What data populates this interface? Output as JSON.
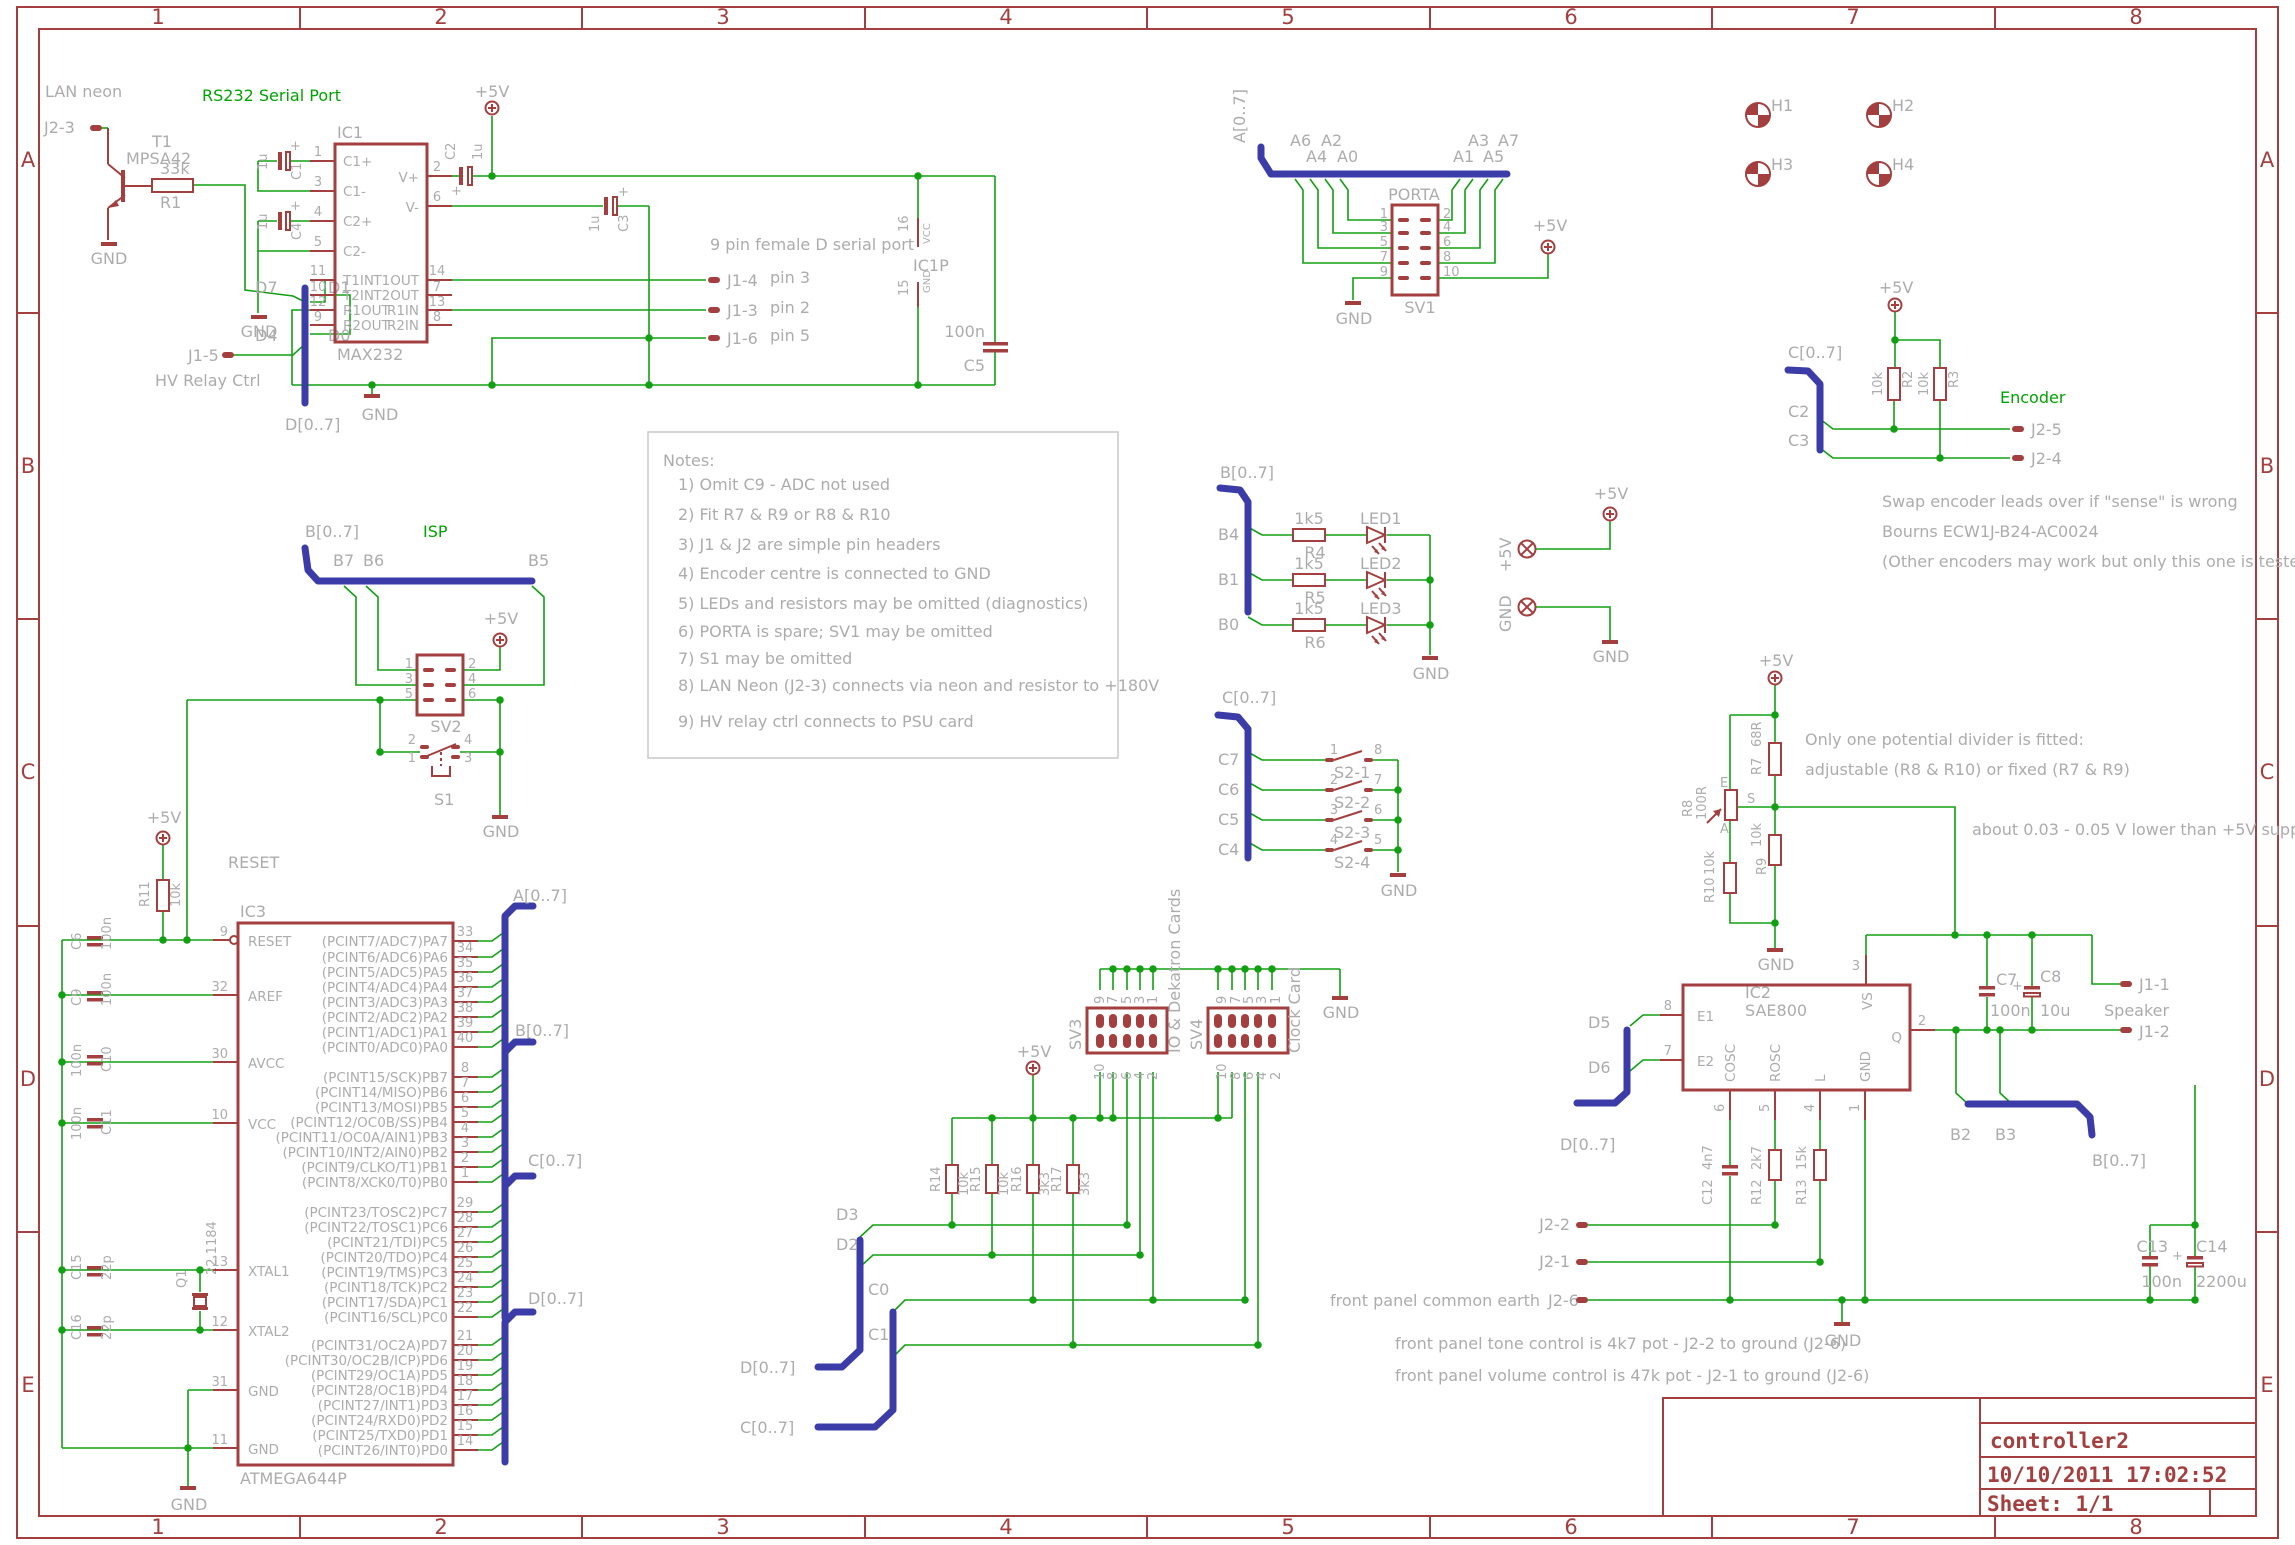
{
  "frame": {
    "cols": [
      "1",
      "2",
      "3",
      "4",
      "5",
      "6",
      "7",
      "8"
    ],
    "rows": [
      "A",
      "B",
      "C",
      "D",
      "E"
    ]
  },
  "title": {
    "project": "controller2",
    "date": "10/10/2011 17:02:52",
    "sheet": "Sheet: 1/1"
  },
  "headers": {
    "rs232": "RS232 Serial Port",
    "isp": "ISP",
    "encoder": "Encoder",
    "porta": "PORTA"
  },
  "notes": {
    "title": "Notes:",
    "items": [
      "1) Omit C9 - ADC not used",
      "2) Fit R7 & R9 or R8 & R10",
      "3) J1 & J2 are simple pin headers",
      "4) Encoder centre is connected to GND",
      "5) LEDs and resistors may be omitted (diagnostics)",
      "6) PORTA is spare; SV1 may be omitted",
      "7) S1 may be omitted",
      "8) LAN Neon (J2-3) connects via neon and resistor to +180V",
      "9) HV relay ctrl connects to PSU card"
    ]
  },
  "annot": {
    "lan": "LAN neon",
    "hv": "HV Relay Ctrl",
    "serial": "9 pin female D serial port",
    "pin3": "pin 3",
    "pin2": "pin 2",
    "pin5": "pin 5",
    "enc1": "Swap encoder leads over if \"sense\" is wrong",
    "enc2": "Bourns ECW1J-B24-AC0024",
    "enc3": "(Other encoders may work but only this one is tested.)",
    "div1": "Only one potential divider is fitted:",
    "div2": "adjustable (R8 & R10) or fixed (R7 & R9)",
    "div3": "about 0.03 - 0.05 V lower than +5V supply",
    "fp_earth": "front panel common earth",
    "fp_tone": "front panel tone control is 4k7 pot - J2-2 to ground (J2-6)",
    "fp_vol": "front panel volume control is 47k pot - J2-1 to ground (J2-6)",
    "io_cards": "IO & Dekatron Cards",
    "clock_card": "Clock Card",
    "speaker": "Speaker"
  },
  "power": {
    "p5": "+5V",
    "gnd": "GND"
  },
  "bus": {
    "a": "A[0..7]",
    "b": "B[0..7]",
    "c": "C[0..7]",
    "d": "D[0..7]"
  },
  "net": {
    "d7": "D7",
    "d1": "D1",
    "d4": "D4",
    "d0": "D0",
    "d3": "D3",
    "d2": "D2",
    "d5": "D5",
    "d6": "D6",
    "b7": "B7",
    "b6": "B6",
    "b5": "B5",
    "b4": "B4",
    "b1": "B1",
    "b0": "B0",
    "b2": "B2",
    "b3": "B3",
    "c7": "C7",
    "c6": "C6",
    "c5": "C5",
    "c4": "C4",
    "c2": "C2",
    "c3": "C3",
    "c0": "C0",
    "c1": "C1",
    "reset": "RESET",
    "a6": "A6",
    "a4": "A4",
    "a2": "A2",
    "a0": "A0",
    "a3": "A3",
    "a1": "A1",
    "a7": "A7",
    "a5": "A5"
  },
  "parts": {
    "t1": {
      "name": "T1",
      "value": "MPSA42"
    },
    "r1": {
      "name": "R1",
      "value": "33k"
    },
    "r2": {
      "name": "R2",
      "value": "10k"
    },
    "r3": {
      "name": "R3",
      "value": "10k"
    },
    "r4": {
      "name": "R4",
      "value": "1k5"
    },
    "r5": {
      "name": "R5",
      "value": "1k5"
    },
    "r6": {
      "name": "R6",
      "value": "1k5"
    },
    "r7": {
      "name": "R7",
      "value": "68R"
    },
    "r8": {
      "name": "R8",
      "value": "100R"
    },
    "r9": {
      "name": "R9",
      "value": "10k"
    },
    "r10": {
      "name": "R10",
      "value": "10k"
    },
    "r11": {
      "name": "R11",
      "value": "10k"
    },
    "r12": {
      "name": "R12",
      "value": "2k7"
    },
    "r13": {
      "name": "R13",
      "value": "15k"
    },
    "r14": {
      "name": "R14",
      "value": "10k"
    },
    "r15": {
      "name": "R15",
      "value": "10k"
    },
    "r16": {
      "name": "R16",
      "value": "3k3"
    },
    "r17": {
      "name": "R17",
      "value": "3k3"
    },
    "c1": {
      "name": "C1",
      "value": "1u"
    },
    "c2": {
      "name": "C2",
      "value": "1u"
    },
    "c3": {
      "name": "C3",
      "value": "1u"
    },
    "c4": {
      "name": "C4",
      "value": "1u"
    },
    "c5": {
      "name": "C5",
      "value": "100n"
    },
    "c6": {
      "name": "C6",
      "value": "100n"
    },
    "c7": {
      "name": "C7",
      "value": "100n"
    },
    "c8": {
      "name": "C8",
      "value": "10u"
    },
    "c9": {
      "name": "C9",
      "value": "100n"
    },
    "c10": {
      "name": "C10",
      "value": "100n"
    },
    "c11": {
      "name": "C11",
      "value": "100n"
    },
    "c12": {
      "name": "C12",
      "value": "4n7"
    },
    "c13": {
      "name": "C13",
      "value": "100n"
    },
    "c14": {
      "name": "C14",
      "value": "2200u"
    },
    "c15": {
      "name": "C15",
      "value": "22p"
    },
    "c16": {
      "name": "C16",
      "value": "22p"
    },
    "q1": {
      "name": "Q1",
      "value": "22.1184"
    },
    "ic1": {
      "name": "IC1",
      "value": "MAX232"
    },
    "ic1p": {
      "name": "IC1P"
    },
    "ic2": {
      "name": "IC2",
      "value": "SAE800"
    },
    "ic3": {
      "name": "IC3",
      "value": "ATMEGA644P"
    },
    "sv1": "SV1",
    "sv2": "SV2",
    "sv3": "SV3",
    "sv4": "SV4",
    "s1": "S1",
    "led1": "LED1",
    "led2": "LED2",
    "led3": "LED3",
    "h1": "H1",
    "h2": "H2",
    "h3": "H3",
    "h4": "H4",
    "plus": "+"
  },
  "s2": [
    {
      "name": "S2-1",
      "l": "1",
      "r": "8"
    },
    {
      "name": "S2-2",
      "l": "2",
      "r": "7"
    },
    {
      "name": "S2-3",
      "l": "3",
      "r": "6"
    },
    {
      "name": "S2-4",
      "l": "4",
      "r": "5"
    }
  ],
  "j": {
    "j23": "J2-3",
    "j15": "J1-5",
    "j14": "J1-4",
    "j13": "J1-3",
    "j16": "J1-6",
    "j25": "J2-5",
    "j24": "J2-4",
    "j11": "J1-1",
    "j12": "J1-2",
    "j22": "J2-2",
    "j21": "J2-1",
    "j26": "J2-6"
  },
  "ic1_pins": {
    "left": [
      {
        "n": "1",
        "t": "C1+"
      },
      {
        "n": "3",
        "t": "C1-"
      },
      {
        "n": "4",
        "t": "C2+"
      },
      {
        "n": "5",
        "t": "C2-"
      },
      {
        "n": "11",
        "t": "T1IN"
      },
      {
        "n": "10",
        "t": "T2IN"
      },
      {
        "n": "12",
        "t": "R1OUT"
      },
      {
        "n": "9",
        "t": "R2OUT"
      }
    ],
    "right": [
      {
        "n": "2",
        "t": "V+"
      },
      {
        "n": "6",
        "t": "V-"
      },
      {
        "n": "14",
        "t": "T1OUT"
      },
      {
        "n": "7",
        "t": "T2OUT"
      },
      {
        "n": "13",
        "t": "R1IN"
      },
      {
        "n": "8",
        "t": "R2IN"
      }
    ]
  },
  "ic1p_pins": {
    "p16": "16",
    "vcc": "VCC",
    "p15": "15",
    "gnd": "GND"
  },
  "ic2_pins": {
    "e1": {
      "n": "8",
      "t": "E1"
    },
    "e2": {
      "n": "7",
      "t": "E2"
    },
    "cosc": {
      "n": "6",
      "t": "COSC"
    },
    "rosc": {
      "n": "5",
      "t": "ROSC"
    },
    "l": {
      "n": "4",
      "t": "L"
    },
    "gnd": {
      "n": "1",
      "t": "GND"
    },
    "vs": {
      "n": "3",
      "t": "VS"
    },
    "q": {
      "n": "2",
      "t": "Q"
    }
  },
  "ic3_pins": {
    "left": [
      {
        "n": "9",
        "t": "RESET"
      },
      {
        "n": "32",
        "t": "AREF"
      },
      {
        "n": "30",
        "t": "AVCC"
      },
      {
        "n": "10",
        "t": "VCC"
      },
      {
        "n": "13",
        "t": "XTAL1"
      },
      {
        "n": "12",
        "t": "XTAL2"
      },
      {
        "n": "31",
        "t": "GND"
      },
      {
        "n": "11",
        "t": "GND"
      }
    ],
    "pa": [
      {
        "n": "33",
        "t": "(PCINT7/ADC7)PA7"
      },
      {
        "n": "34",
        "t": "(PCINT6/ADC6)PA6"
      },
      {
        "n": "35",
        "t": "(PCINT5/ADC5)PA5"
      },
      {
        "n": "36",
        "t": "(PCINT4/ADC4)PA4"
      },
      {
        "n": "37",
        "t": "(PCINT3/ADC3)PA3"
      },
      {
        "n": "38",
        "t": "(PCINT2/ADC2)PA2"
      },
      {
        "n": "39",
        "t": "(PCINT1/ADC1)PA1"
      },
      {
        "n": "40",
        "t": "(PCINT0/ADC0)PA0"
      }
    ],
    "pb": [
      {
        "n": "8",
        "t": "(PCINT15/SCK)PB7"
      },
      {
        "n": "7",
        "t": "(PCINT14/MISO)PB6"
      },
      {
        "n": "6",
        "t": "(PCINT13/MOSI)PB5"
      },
      {
        "n": "5",
        "t": "(PCINT12/OC0B/SS)PB4"
      },
      {
        "n": "4",
        "t": "(PCINT11/OC0A/AIN1)PB3"
      },
      {
        "n": "3",
        "t": "(PCINT10/INT2/AIN0)PB2"
      },
      {
        "n": "2",
        "t": "(PCINT9/CLKO/T1)PB1"
      },
      {
        "n": "1",
        "t": "(PCINT8/XCK0/T0)PB0"
      }
    ],
    "pc": [
      {
        "n": "29",
        "t": "(PCINT23/TOSC2)PC7"
      },
      {
        "n": "28",
        "t": "(PCINT22/TOSC1)PC6"
      },
      {
        "n": "27",
        "t": "(PCINT21/TDI)PC5"
      },
      {
        "n": "26",
        "t": "(PCINT20/TDO)PC4"
      },
      {
        "n": "25",
        "t": "(PCINT19/TMS)PC3"
      },
      {
        "n": "24",
        "t": "(PCINT18/TCK)PC2"
      },
      {
        "n": "23",
        "t": "(PCINT17/SDA)PC1"
      },
      {
        "n": "22",
        "t": "(PCINT16/SCL)PC0"
      }
    ],
    "pd": [
      {
        "n": "21",
        "t": "(PCINT31/OC2A)PD7"
      },
      {
        "n": "20",
        "t": "(PCINT30/OC2B/ICP)PD6"
      },
      {
        "n": "19",
        "t": "(PCINT29/OC1A)PD5"
      },
      {
        "n": "18",
        "t": "(PCINT28/OC1B)PD4"
      },
      {
        "n": "17",
        "t": "(PCINT27/INT1)PD3"
      },
      {
        "n": "16",
        "t": "(PCINT24/RXD0)PD2"
      },
      {
        "n": "15",
        "t": "(PCINT25/TXD0)PD1"
      },
      {
        "n": "14",
        "t": "(PCINT26/INT0)PD0"
      }
    ]
  },
  "sv1_pins": {
    "l": [
      "1",
      "3",
      "5",
      "7",
      "9"
    ],
    "r": [
      "2",
      "4",
      "6",
      "8",
      "10"
    ]
  },
  "sv2_pins": {
    "l": [
      "1",
      "3",
      "5"
    ],
    "r": [
      "2",
      "4",
      "6"
    ]
  },
  "s1_pins": {
    "p2": "2",
    "p1": "1",
    "p4": "4",
    "p3": "3"
  },
  "sv34_pins": {
    "top": [
      "9",
      "7",
      "5",
      "3",
      "1"
    ],
    "bot": [
      "10",
      "8",
      "6",
      "4",
      "2"
    ]
  },
  "pot": {
    "e": "E",
    "s": "S",
    "a": "A"
  }
}
